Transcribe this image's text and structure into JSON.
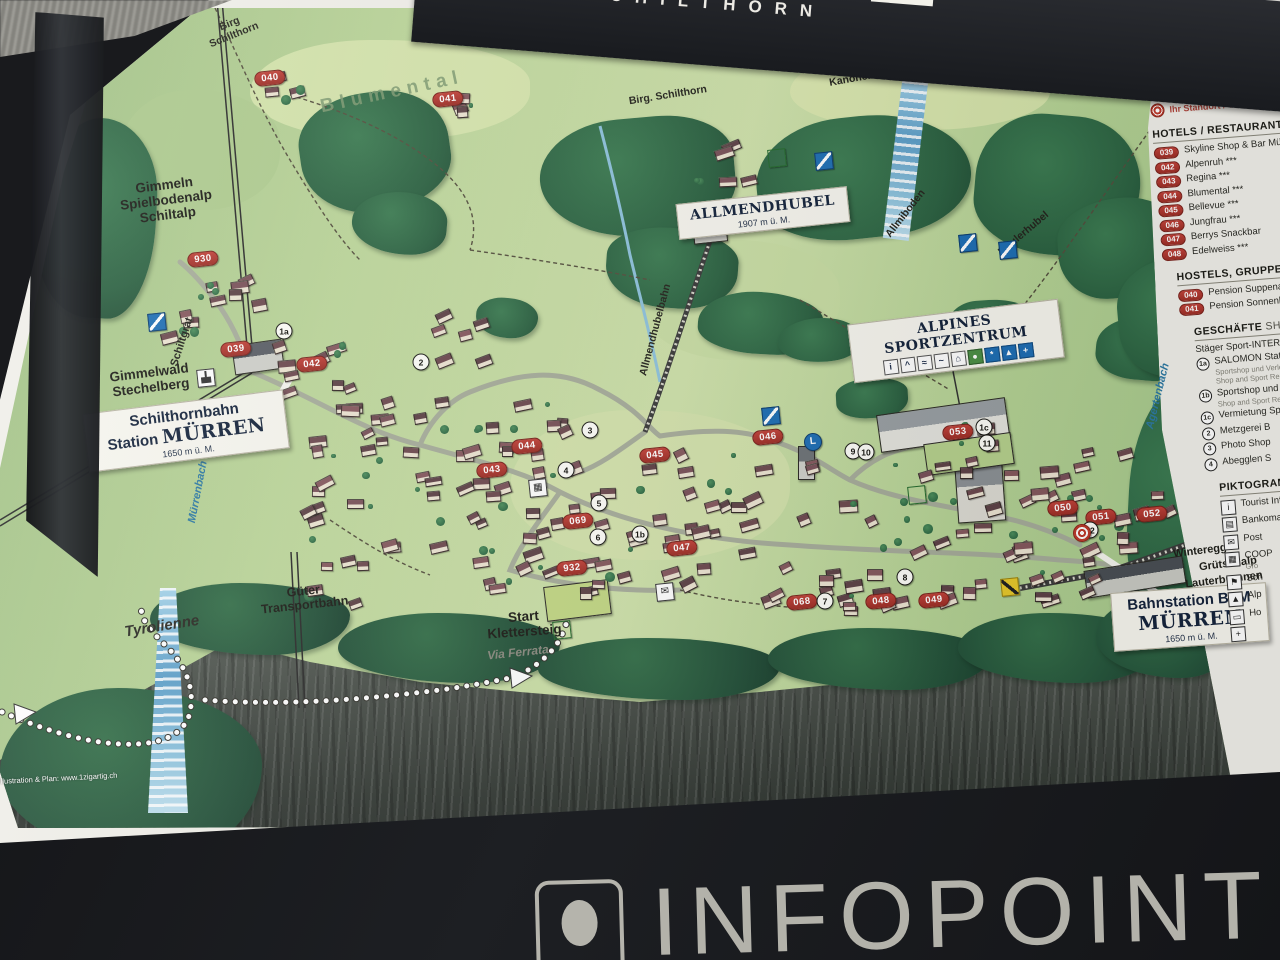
{
  "header": {
    "brand": "SCHILTHORN"
  },
  "footer": {
    "label": "INFOPOINT"
  },
  "map": {
    "boxes": [
      {
        "id": "allmendhubel",
        "title": "ALLMENDHUBEL",
        "sub": "1907 m ü. M.",
        "x": 763,
        "y": 213,
        "w": 152,
        "r": -6,
        "icons": []
      },
      {
        "id": "sportzentrum",
        "title": "ALPINES SPORTZENTRUM",
        "sub": "",
        "x": 956,
        "y": 341,
        "w": 192,
        "r": -7,
        "icons": [
          {
            "c": "w",
            "t": "i"
          },
          {
            "c": "w",
            "t": "^"
          },
          {
            "c": "w",
            "t": "≈"
          },
          {
            "c": "w",
            "t": "~"
          },
          {
            "c": "w",
            "t": "⌂"
          },
          {
            "c": "g",
            "t": "●"
          },
          {
            "c": "b",
            "t": "*"
          },
          {
            "c": "b",
            "t": "▲"
          },
          {
            "c": "b",
            "t": "+"
          }
        ]
      },
      {
        "id": "schilthornbahn",
        "line1": "Schilthornbahn",
        "line2_pre": "Station ",
        "line2_em": "MÜRREN",
        "sub": "1650 m ü. M.",
        "x": 186,
        "y": 431,
        "w": 182,
        "r": -7,
        "icons": []
      },
      {
        "id": "bahnstation",
        "line1": "Bahnstation BLM",
        "line2_pre": "",
        "line2_em": "MÜRREN",
        "sub": "1650 m ü. M.",
        "x": 1190,
        "y": 617,
        "w": 136,
        "r": -4,
        "icons": []
      }
    ],
    "labels": [
      {
        "t": [
          "Birg",
          "Schilthorn"
        ],
        "x": 232,
        "y": 30,
        "r": -22,
        "c": "sm"
      },
      {
        "t": [
          "Blumental"
        ],
        "x": 392,
        "y": 92,
        "r": -12,
        "c": "area"
      },
      {
        "t": [
          "Birg. Schilthorn"
        ],
        "x": 668,
        "y": 96,
        "r": -9,
        "c": "sm"
      },
      {
        "t": [
          "Kanonenrohr"
        ],
        "x": 862,
        "y": 78,
        "r": -10,
        "c": "sm"
      },
      {
        "t": [
          "Allmiboden"
        ],
        "x": 906,
        "y": 214,
        "r": -52,
        "c": "sm"
      },
      {
        "t": [
          "Maulerhubel"
        ],
        "x": 1024,
        "y": 234,
        "r": -40,
        "c": "sm"
      },
      {
        "t": [
          "Allmendhubelbahn"
        ],
        "x": 656,
        "y": 330,
        "r": -75,
        "c": "sm"
      },
      {
        "t": [
          "Gimmeln",
          "Spielbodenalp",
          "Schiltalp"
        ],
        "x": 166,
        "y": 200,
        "r": -7,
        "c": "place"
      },
      {
        "t": [
          "Schiltgrat"
        ],
        "x": 182,
        "y": 342,
        "r": -72,
        "c": "sm2"
      },
      {
        "t": [
          "Gimmelwald",
          "Stechelberg"
        ],
        "x": 150,
        "y": 380,
        "r": -7,
        "c": "place"
      },
      {
        "t": [
          "Mürrenbach"
        ],
        "x": 198,
        "y": 492,
        "r": -79,
        "c": "water"
      },
      {
        "t": [
          "Tyrolienne"
        ],
        "x": 162,
        "y": 627,
        "r": -9,
        "c": "tyro"
      },
      {
        "t": [
          "Güter",
          "Transportbahn"
        ],
        "x": 304,
        "y": 598,
        "r": -6,
        "c": "place2"
      },
      {
        "t": [
          "Start",
          "Klettersteig"
        ],
        "x": 524,
        "y": 624,
        "r": -4,
        "c": "place"
      },
      {
        "t": [
          "Via Ferrata"
        ],
        "x": 518,
        "y": 653,
        "r": -6,
        "c": "faded"
      },
      {
        "t": [
          "Winteregg"
        ],
        "x": 1200,
        "y": 551,
        "r": -7,
        "c": "sm2"
      },
      {
        "t": [
          "Grütschalp"
        ],
        "x": 1228,
        "y": 564,
        "r": -7,
        "c": "sm2"
      },
      {
        "t": [
          "Lauterbrunnen"
        ],
        "x": 1224,
        "y": 580,
        "r": -7,
        "c": "sm2"
      },
      {
        "t": [
          "Agertenbach"
        ],
        "x": 1158,
        "y": 396,
        "r": -76,
        "c": "water"
      },
      {
        "t": [
          "Illustration & Plan: www.1zigartig.ch"
        ],
        "x": 58,
        "y": 779,
        "r": -3,
        "c": "credit"
      }
    ],
    "badges": [
      {
        "n": "040",
        "x": 270,
        "y": 78
      },
      {
        "n": "041",
        "x": 448,
        "y": 99
      },
      {
        "n": "930",
        "x": 203,
        "y": 259
      },
      {
        "n": "039",
        "x": 236,
        "y": 349
      },
      {
        "n": "042",
        "x": 312,
        "y": 364
      },
      {
        "n": "043",
        "x": 492,
        "y": 470
      },
      {
        "n": "044",
        "x": 527,
        "y": 446
      },
      {
        "n": "045",
        "x": 655,
        "y": 455
      },
      {
        "n": "046",
        "x": 768,
        "y": 437
      },
      {
        "n": "047",
        "x": 682,
        "y": 548
      },
      {
        "n": "048",
        "x": 881,
        "y": 601
      },
      {
        "n": "049",
        "x": 934,
        "y": 600
      },
      {
        "n": "050",
        "x": 1063,
        "y": 508
      },
      {
        "n": "051",
        "x": 1101,
        "y": 517
      },
      {
        "n": "052",
        "x": 1152,
        "y": 514
      },
      {
        "n": "053",
        "x": 958,
        "y": 432
      },
      {
        "n": "068",
        "x": 802,
        "y": 602
      },
      {
        "n": "069",
        "x": 578,
        "y": 521
      },
      {
        "n": "932",
        "x": 572,
        "y": 568
      }
    ],
    "circles": [
      {
        "n": "1a",
        "x": 284,
        "y": 331
      },
      {
        "n": "2",
        "x": 421,
        "y": 362
      },
      {
        "n": "3",
        "x": 590,
        "y": 430
      },
      {
        "n": "4",
        "x": 566,
        "y": 470
      },
      {
        "n": "5",
        "x": 599,
        "y": 503
      },
      {
        "n": "6",
        "x": 598,
        "y": 537
      },
      {
        "n": "1b",
        "x": 640,
        "y": 534
      },
      {
        "n": "7",
        "x": 825,
        "y": 601
      },
      {
        "n": "8",
        "x": 905,
        "y": 577
      },
      {
        "n": "9",
        "x": 853,
        "y": 451
      },
      {
        "n": "10",
        "x": 866,
        "y": 452
      },
      {
        "n": "1c",
        "x": 984,
        "y": 427
      },
      {
        "n": "11",
        "x": 987,
        "y": 443
      },
      {
        "n": "12",
        "x": 1090,
        "y": 530
      }
    ],
    "icons": [
      {
        "k": "lift",
        "x": 157,
        "y": 322
      },
      {
        "k": "lift",
        "x": 824,
        "y": 161
      },
      {
        "k": "lift",
        "x": 968,
        "y": 243
      },
      {
        "k": "lift",
        "x": 1008,
        "y": 250
      },
      {
        "k": "lift",
        "x": 771,
        "y": 416
      },
      {
        "k": "green",
        "x": 777,
        "y": 158
      },
      {
        "k": "green",
        "x": 917,
        "y": 495
      },
      {
        "k": "green",
        "x": 562,
        "y": 630
      },
      {
        "k": "cable",
        "x": 206,
        "y": 378
      },
      {
        "k": "post",
        "x": 665,
        "y": 592,
        "t": "✉"
      },
      {
        "k": "cart",
        "x": 538,
        "y": 488,
        "t": "▦"
      },
      {
        "k": "L",
        "x": 813,
        "y": 442,
        "t": "L"
      },
      {
        "k": "target",
        "x": 1082,
        "y": 533
      },
      {
        "k": "para",
        "x": 1010,
        "y": 587
      }
    ]
  },
  "legend": {
    "you_are_here": "Ihr Standort / You are here",
    "sections": [
      {
        "title": "HOTELS / RESTAURANTS",
        "title_light": "",
        "items": [
          {
            "badge": "039",
            "text": "Skyline Shop & Bar Mürren"
          },
          {
            "badge": "042",
            "text": "Alpenruh ***"
          },
          {
            "badge": "043",
            "text": "Regina ***"
          },
          {
            "badge": "044",
            "text": "Blumental ***"
          },
          {
            "badge": "045",
            "text": "Bellevue ***"
          },
          {
            "badge": "046",
            "text": "Jungfrau ***"
          },
          {
            "badge": "047",
            "text": "Berrys Snackbar"
          },
          {
            "badge": "048",
            "text": "Edelweiss ***"
          }
        ]
      },
      {
        "title": "HOSTELS, GRUPPENUNTERKÜNFTE",
        "title_light": "",
        "items": [
          {
            "badge": "040",
            "text": "Pension Suppenalp"
          },
          {
            "badge": "041",
            "text": "Pension Sonnenberg"
          }
        ]
      },
      {
        "title": "GESCHÄFTE",
        "title_light": " SHOPS",
        "items": [
          {
            "text": "Stäger Sport-INTERSPORT"
          },
          {
            "circle": "1a",
            "text": "SALOMON Station",
            "subs": [
              "Sportshop und Verleih",
              "Shop and Sport Rental"
            ]
          },
          {
            "circle": "1b",
            "text": "Sportshop und Verleih",
            "subs": [
              "Shop and Sport Rental"
            ]
          },
          {
            "circle": "1c",
            "text": "Vermietung Sport"
          },
          {
            "circle": "2",
            "text": "Metzgerei B"
          },
          {
            "circle": "3",
            "text": "Photo Shop"
          },
          {
            "circle": "4",
            "text": "Abegglen S"
          }
        ]
      },
      {
        "title": "PIKTOGRAMME",
        "title_light": "",
        "items": [
          {
            "icon": "i",
            "text": "Tourist Information"
          },
          {
            "icon": "▤",
            "text": "Bankomat"
          },
          {
            "icon": "✉",
            "text": "Post"
          },
          {
            "icon": "▦",
            "text": "COOP",
            "subs": [
              "Gro"
            ]
          },
          {
            "icon": "⚑",
            "text": "Sch"
          },
          {
            "icon": "▲",
            "text": "Alp"
          },
          {
            "icon": "▭",
            "text": "Ho"
          },
          {
            "icon": "+",
            "text": ""
          }
        ]
      }
    ]
  }
}
